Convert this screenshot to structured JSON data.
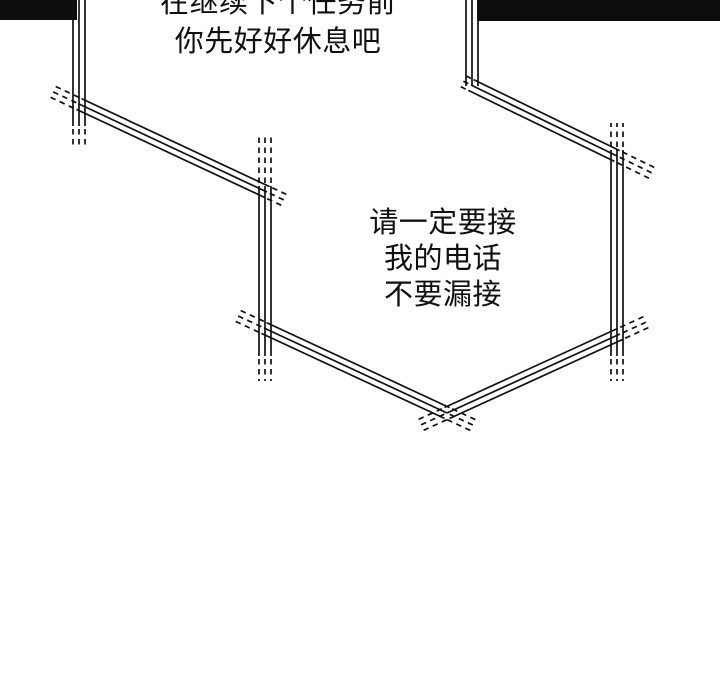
{
  "page": {
    "background": "#ffffff",
    "ink": "#101010",
    "panel_edge_color": "#0d0d0d"
  },
  "top_dialogue": {
    "line1": "在继续下个任务前",
    "line2": "你先好好休息吧"
  },
  "bubble_dialogue": {
    "line1": "请一定要接",
    "line2": "我的电话",
    "line3": "不要漏接"
  }
}
